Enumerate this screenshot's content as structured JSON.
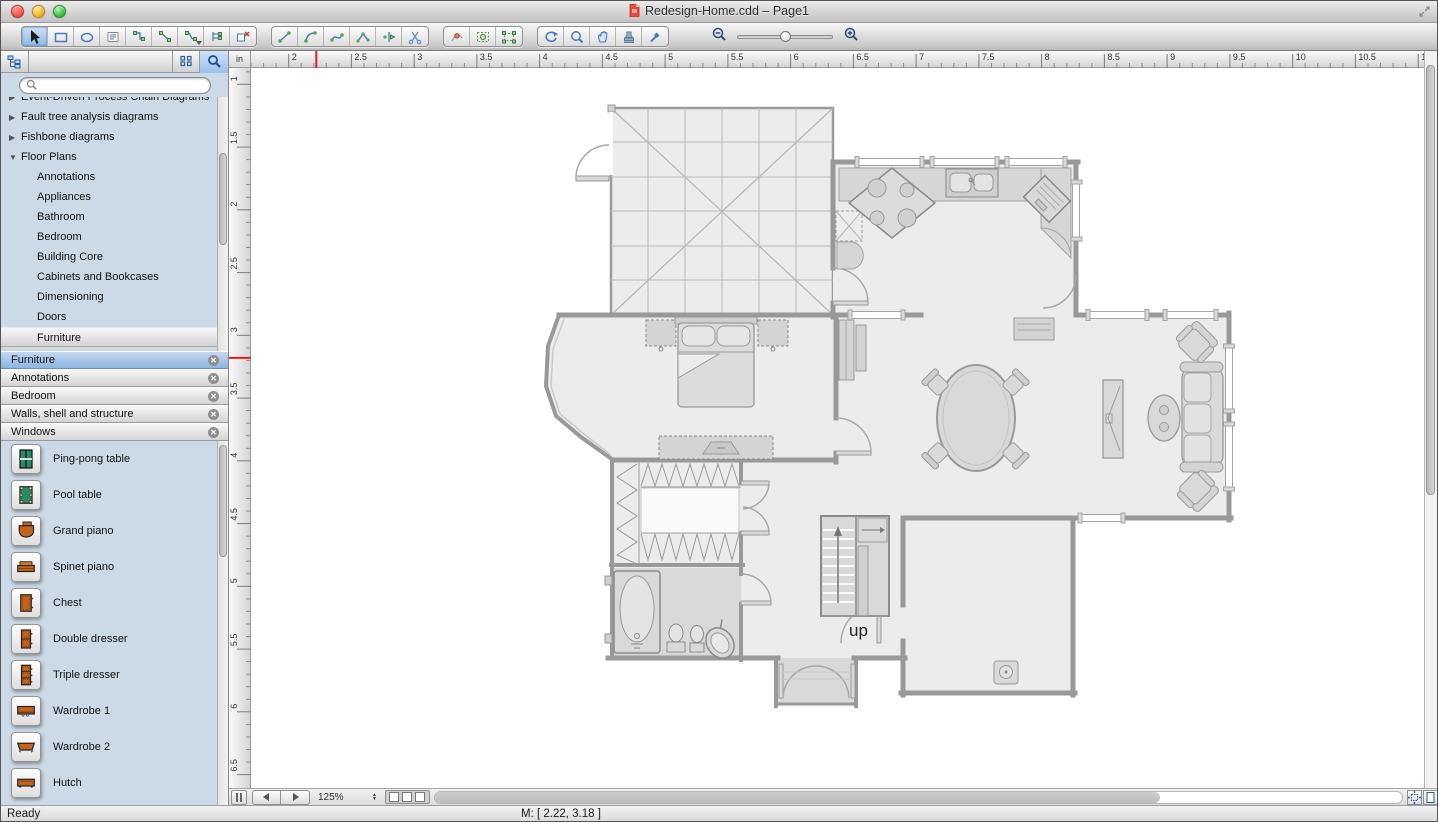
{
  "window": {
    "title": "Redesign-Home.cdd – Page1"
  },
  "toolbar": {
    "groups": [
      {
        "name": "shape-tools",
        "tools": [
          {
            "id": "select-tool",
            "icon": "arrow-icon",
            "selected": true
          },
          {
            "id": "rectangle-tool",
            "icon": "rect-icon"
          },
          {
            "id": "ellipse-tool",
            "icon": "ellipse-icon"
          },
          {
            "id": "text-tool",
            "icon": "text-icon"
          },
          {
            "id": "smart-connector-tool",
            "icon": "connector-elbow-icon"
          },
          {
            "id": "direct-connector-tool",
            "icon": "connector-line-icon"
          },
          {
            "id": "curve-connector-tool",
            "icon": "connector-curve-icon",
            "caret": true
          },
          {
            "id": "tree-connector-tool",
            "icon": "connector-tree-icon"
          },
          {
            "id": "disconnect-tool",
            "icon": "disconnect-icon"
          }
        ]
      },
      {
        "name": "draw-tools",
        "tools": [
          {
            "id": "line-tool",
            "icon": "line-icon"
          },
          {
            "id": "arc-tool",
            "icon": "arc-icon"
          },
          {
            "id": "bezier-tool",
            "icon": "curve-icon"
          },
          {
            "id": "polyline-tool",
            "icon": "polyline-icon"
          },
          {
            "id": "split-tool",
            "icon": "split-icon"
          },
          {
            "id": "scissors-tool",
            "icon": "scissors-icon"
          }
        ]
      },
      {
        "name": "transform-tools",
        "tools": [
          {
            "id": "reshape-tool",
            "icon": "reshape-icon"
          },
          {
            "id": "group-select-tool",
            "icon": "group-select-icon"
          },
          {
            "id": "group-move-tool",
            "icon": "group-move-icon"
          }
        ]
      },
      {
        "name": "view-tools",
        "tools": [
          {
            "id": "rotate-tool",
            "icon": "rotate-icon"
          },
          {
            "id": "zoom-tool",
            "icon": "magnifier-icon"
          },
          {
            "id": "pan-tool",
            "icon": "hand-icon"
          },
          {
            "id": "stamp-tool",
            "icon": "stamp-icon"
          },
          {
            "id": "pick-tool",
            "icon": "eyedropper-icon"
          }
        ]
      }
    ],
    "zoom_slider": {
      "thumb_percent": 42
    }
  },
  "sidebar": {
    "search": {
      "value": ""
    },
    "tree": {
      "items": [
        {
          "label": "Event-Driven Process Chain Diagrams",
          "type": "collapsed",
          "clipped": true
        },
        {
          "label": "Fault tree analysis diagrams",
          "type": "collapsed"
        },
        {
          "label": "Fishbone diagrams",
          "type": "collapsed"
        },
        {
          "label": "Floor Plans",
          "type": "expanded"
        },
        {
          "label": "Annotations",
          "type": "child"
        },
        {
          "label": "Appliances",
          "type": "child"
        },
        {
          "label": "Bathroom",
          "type": "child"
        },
        {
          "label": "Bedroom",
          "type": "child"
        },
        {
          "label": "Building Core",
          "type": "child"
        },
        {
          "label": "Cabinets and Bookcases",
          "type": "child"
        },
        {
          "label": "Dimensioning",
          "type": "child"
        },
        {
          "label": "Doors",
          "type": "child"
        },
        {
          "label": "Furniture",
          "type": "child",
          "selected": true
        }
      ]
    },
    "libraries": [
      {
        "label": "Furniture",
        "selected": true
      },
      {
        "label": "Annotations",
        "selected": false
      },
      {
        "label": "Bedroom",
        "selected": false
      },
      {
        "label": "Walls, shell and structure",
        "selected": false
      },
      {
        "label": "Windows",
        "selected": false
      }
    ],
    "shapes": [
      {
        "label": "Ping-pong table",
        "icon": "ping-pong-table-icon"
      },
      {
        "label": "Pool table",
        "icon": "pool-table-icon"
      },
      {
        "label": "Grand piano",
        "icon": "grand-piano-icon"
      },
      {
        "label": "Spinet piano",
        "icon": "spinet-piano-icon"
      },
      {
        "label": "Chest",
        "icon": "chest-icon"
      },
      {
        "label": "Double dresser",
        "icon": "double-dresser-icon"
      },
      {
        "label": "Triple dresser",
        "icon": "triple-dresser-icon"
      },
      {
        "label": "Wardrobe 1",
        "icon": "wardrobe1-icon"
      },
      {
        "label": "Wardrobe 2",
        "icon": "wardrobe2-icon"
      },
      {
        "label": "Hutch",
        "icon": "hutch-icon"
      }
    ]
  },
  "canvas": {
    "unit": "in",
    "h_ruler": {
      "unit_start": 1.7,
      "unit_end": 11.15,
      "px_per_unit": 125.5,
      "label_step": 0.5,
      "tick_step": 0.1,
      "marker_value": 2.22
    },
    "v_ruler": {
      "unit_start": 0.87,
      "unit_end": 6.6,
      "px_per_unit": 125.5,
      "label_step": 0.5,
      "tick_step": 0.1,
      "marker_value": 3.18
    },
    "plan": {
      "up_label": "up"
    }
  },
  "bottom_bar": {
    "zoom_level": "125%",
    "page_boxes": 3
  },
  "statusbar": {
    "ready": "Ready",
    "mouse": "M: [ 2.22, 3.18 ]"
  },
  "colors": {
    "accent_blue": "#3d78c8",
    "selection_blue": "#9cc0ea",
    "sidebar_bg": "#ccd9e6",
    "shape_green": "#2a8a66",
    "shape_orange": "#c2641c",
    "marker_red": "#e02020"
  }
}
